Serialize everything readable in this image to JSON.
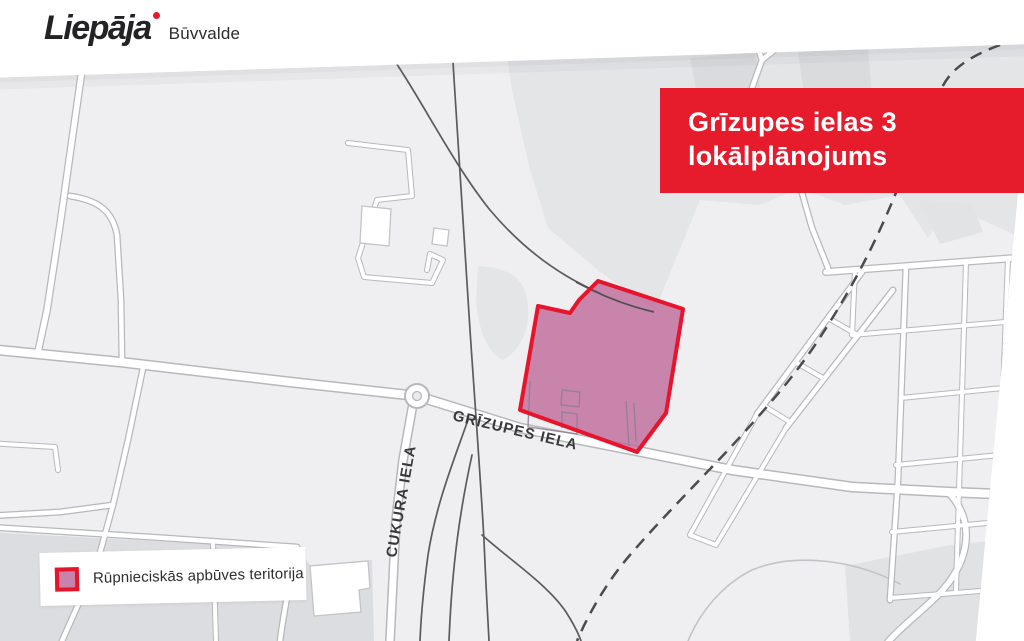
{
  "header": {
    "logo_text": "Liepāja",
    "logo_sub": "Būvvalde"
  },
  "banner": {
    "line1": "Grīzupes ielas 3",
    "line2": "lokālplānojums"
  },
  "map": {
    "street_labels": [
      {
        "id": "grizupes-iela",
        "text": "GRĪZUPES IELA"
      },
      {
        "id": "cukura-iela",
        "text": "CUKURA IELA"
      }
    ]
  },
  "legend": {
    "items": [
      {
        "label": "Rūpnieciskās apbūves teritorija",
        "swatch_fill": "#c783ab",
        "swatch_border": "#e6152b"
      }
    ]
  },
  "colors": {
    "accent_red": "#e61b2c",
    "zone_fill": "#c783ab",
    "zone_border": "#e6152b",
    "map_background": "#efeff1"
  }
}
